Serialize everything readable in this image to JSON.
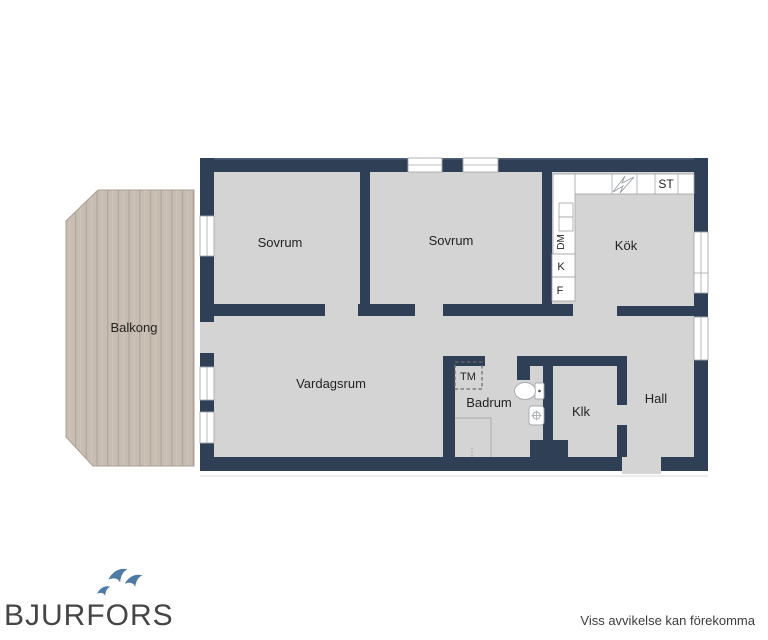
{
  "floor_plan": {
    "rooms": {
      "sovrum_1": {
        "label": "Sovrum"
      },
      "sovrum_2": {
        "label": "Sovrum"
      },
      "kok": {
        "label": "Kök"
      },
      "balkong": {
        "label": "Balkong"
      },
      "vardagsrum": {
        "label": "Vardagsrum"
      },
      "badrum": {
        "label": "Badrum"
      },
      "klk": {
        "label": "Klk"
      },
      "hall": {
        "label": "Hall"
      }
    },
    "fixtures": {
      "washing_machine": "TM",
      "storage_closet": "ST",
      "fridge": "K",
      "freezer": "F",
      "dishwasher": "DM"
    }
  },
  "branding": {
    "logo_text": "BJURFORS"
  },
  "footer": {
    "disclaimer": "Viss avvikelse kan förekomma"
  },
  "colors": {
    "wall": "#2e3f56",
    "floor": "#d4d4d4",
    "balcony": "#c8bdb2",
    "balcony_stripe": "#b3a89d",
    "brand_blue": "#4d7ba6",
    "logo_text_color": "#454547"
  }
}
